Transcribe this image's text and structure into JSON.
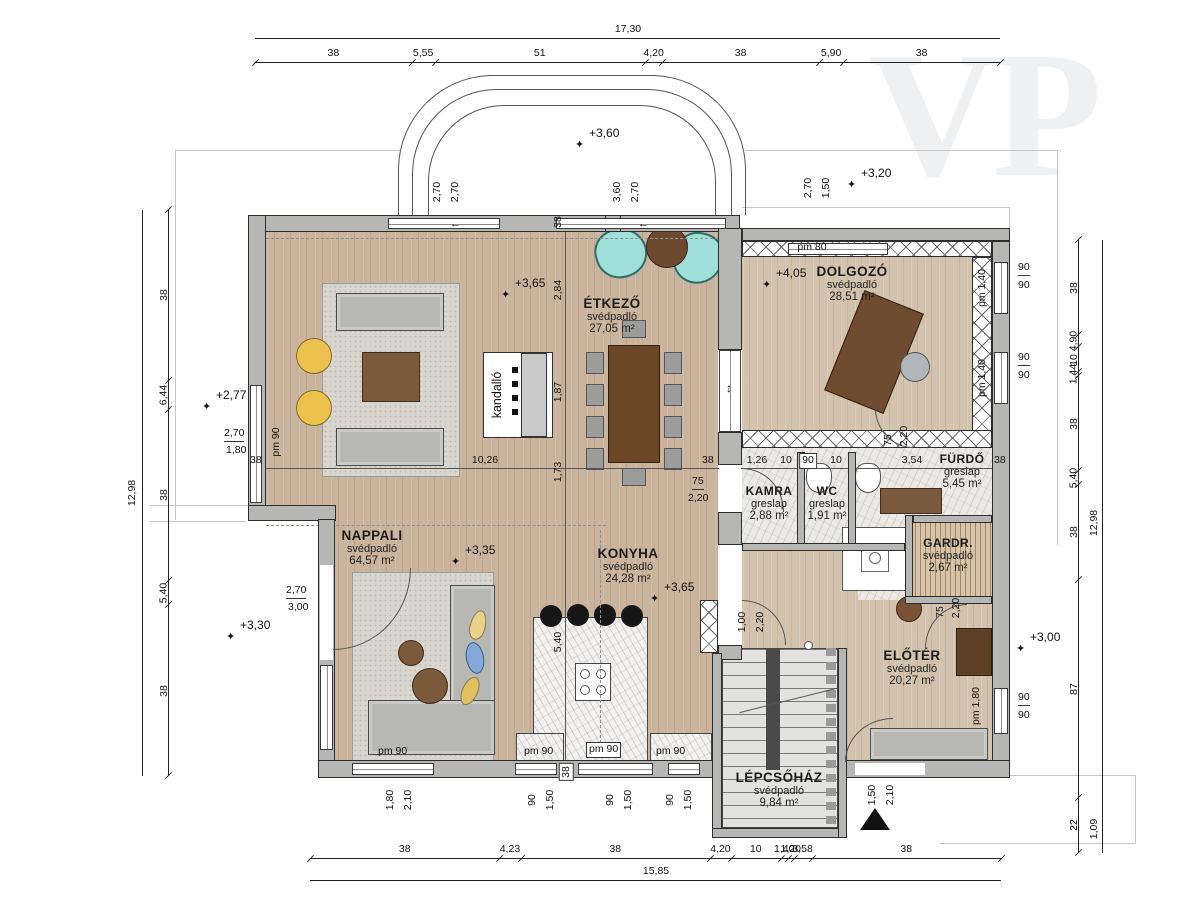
{
  "watermark": "VP",
  "colors": {
    "wall": "#b6b6b5",
    "wood_floor": "#cbb49d",
    "tile_floor": "#edeae6",
    "armchair_teal": "#9fe0da",
    "armchair_yellow": "#ecc14d",
    "table_brown": "#6f4b30",
    "sofa_gray": "#b7b7b4"
  },
  "dims": {
    "top": {
      "total": "17,30",
      "segments": [
        "38",
        "5,55",
        "51",
        "4,20",
        "38",
        "5,90",
        "38"
      ]
    },
    "bottom": {
      "total": "15,85",
      "segments": [
        "38",
        "4,23",
        "38",
        "4,20",
        "10",
        "1,40",
        "1,20",
        "3,58",
        "38"
      ]
    },
    "left": {
      "total": "12,98",
      "segments": [
        "38",
        "6,44",
        "38",
        "5,40",
        "38"
      ]
    },
    "right": {
      "total": "12,98",
      "total2": "1,09",
      "segments": [
        "38",
        "4,90",
        "10",
        "1,44",
        "38",
        "5,40",
        "38",
        "87",
        "22"
      ]
    }
  },
  "rooms": {
    "etkezo": {
      "name": "ÉTKEZŐ",
      "floor": "svédpadló",
      "area": "27,05 m²"
    },
    "dolgozo": {
      "name": "DOLGOZÓ",
      "floor": "svédpadló",
      "area": "28,51 m²"
    },
    "nappali": {
      "name": "NAPPALI",
      "floor": "svédpadló",
      "area": "64,57 m²"
    },
    "konyha": {
      "name": "KONYHA",
      "floor": "svédpadló",
      "area": "24,28 m²"
    },
    "kamra": {
      "name": "KAMRA",
      "floor": "greslap",
      "area": "2,88 m²"
    },
    "wc": {
      "name": "WC",
      "floor": "greslap",
      "area": "1,91 m²"
    },
    "furdo": {
      "name": "FÜRDŐ",
      "floor": "greslap",
      "area": "5,45 m²"
    },
    "gardrob": {
      "name": "GARDR.",
      "floor": "svédpadló",
      "area": "2,67 m²"
    },
    "eloter": {
      "name": "ELŐTÉR",
      "floor": "svédpadló",
      "area": "20,27 m²"
    },
    "lepcsohaz": {
      "name": "LÉPCSŐHÁZ",
      "floor": "svédpadló",
      "area": "9,84 m²"
    }
  },
  "levels": {
    "top": "+3,60",
    "top_right": "+3,20",
    "left": "+2,77",
    "dolgozo": "+4,05",
    "etkezo": "+3,65",
    "konyha": "+3,65",
    "nappali": "+3,35",
    "nappali_sw": "+3,30",
    "eloter": "+3,00"
  },
  "openings": {
    "top_win_left": {
      "a": "2,70",
      "b": "2,70"
    },
    "top_win_mid": {
      "a": "3,60",
      "b": "2,70"
    },
    "top_win_right": {
      "a": "2,70",
      "b": "1,50"
    },
    "left_win": {
      "a": "2,70",
      "b": "1,80"
    },
    "left_door": {
      "a": "2,70",
      "b": "3,00"
    },
    "south_door": {
      "a": "1,80",
      "b": "2,10"
    },
    "south_win": {
      "a": "90",
      "b": "1,50"
    },
    "east_win": {
      "a": "90",
      "b": "90"
    },
    "kamra_door": {
      "a": "75",
      "b": "2,20"
    },
    "furdo_door": {
      "a": "75",
      "b": "2,20"
    },
    "gardrob_door": {
      "a": "75",
      "b": "2,20"
    },
    "stair_door": {
      "a": "1,00",
      "b": "2,20"
    },
    "entry_door": {
      "a": "1,50",
      "b": "2,10"
    }
  },
  "interior_dims": {
    "w38": "38",
    "v1": "2,84",
    "v2": "1,87",
    "v3": "1,73",
    "island": "5,40",
    "h1": "10,26",
    "b1": "38",
    "b2": "1,26",
    "b3": "10",
    "b4": "90",
    "b5": "10",
    "b6": "3,54",
    "b7": "38"
  },
  "pm": {
    "pm80": "pm 80",
    "pm90": "pm 90",
    "pm140": "pm 1,40",
    "pm180": "pm 1,80"
  },
  "fireplace_label": "kandalló",
  "glyphs": {
    "slide_left": "←",
    "slide_v": "↕",
    "star": "✦"
  }
}
